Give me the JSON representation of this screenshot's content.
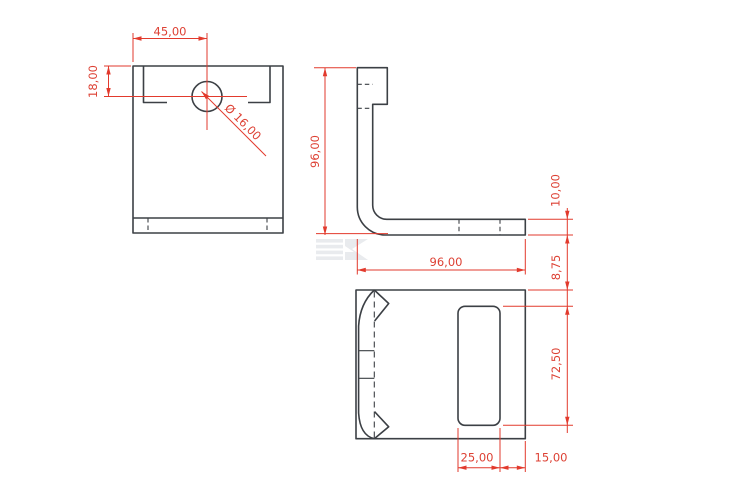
{
  "drawing": {
    "colors": {
      "background": "#ffffff",
      "geometry_line": "#3c4045",
      "dimension": "#e23a2d",
      "watermark": "#e9ebee"
    },
    "front_view": {
      "dim_hole_offset_x": "45,00",
      "dim_hole_offset_y": "18,00",
      "dim_hole_diameter": "Ø 16,00"
    },
    "side_view": {
      "dim_height": "96,00",
      "dim_length": "96,00",
      "dim_flange_thickness": "10,00"
    },
    "top_view": {
      "dim_edge_to_slot": "8,75",
      "dim_slot_length": "72,50",
      "dim_slot_width": "25,00",
      "dim_slot_to_edge": "15,00"
    },
    "icons": {
      "watermark": "ek-logo-watermark"
    }
  }
}
